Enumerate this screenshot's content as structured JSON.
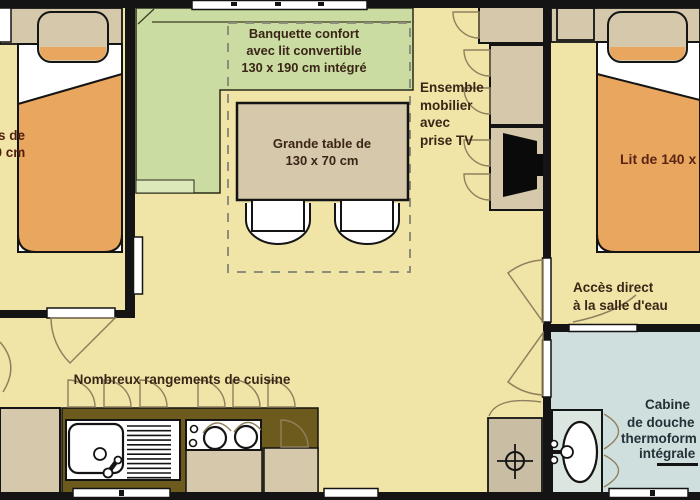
{
  "labels": {
    "banquette": [
      "Banquette confort",
      "avec lit convertible",
      "130 x 190 cm intégré"
    ],
    "table": [
      "Grande table de",
      "130 x 70 cm"
    ],
    "ensemble": [
      "Ensemble",
      "mobilier",
      "avec",
      "prise TV"
    ],
    "kitchen": "Nombreux rangements de cuisine",
    "bed_right": "Lit de 140 x",
    "bed_left": [
      "s de",
      "90 cm"
    ],
    "acces": [
      "Accès direct",
      "à la salle d'eau"
    ],
    "cabine": [
      "Cabine",
      "de douche",
      "thermoform",
      "intégrale"
    ]
  },
  "colors": {
    "floor": "#f0e5a7",
    "banquette_green": "#cbdca3",
    "furniture_tan": "#d5c8ab",
    "bed_orange": "#e9a65f",
    "kitchen_counter_olive": "#6d5b1d",
    "bathroom_blue": "#cfdfdd",
    "walls_black": "#141414",
    "text_brown": "#3a2517"
  }
}
